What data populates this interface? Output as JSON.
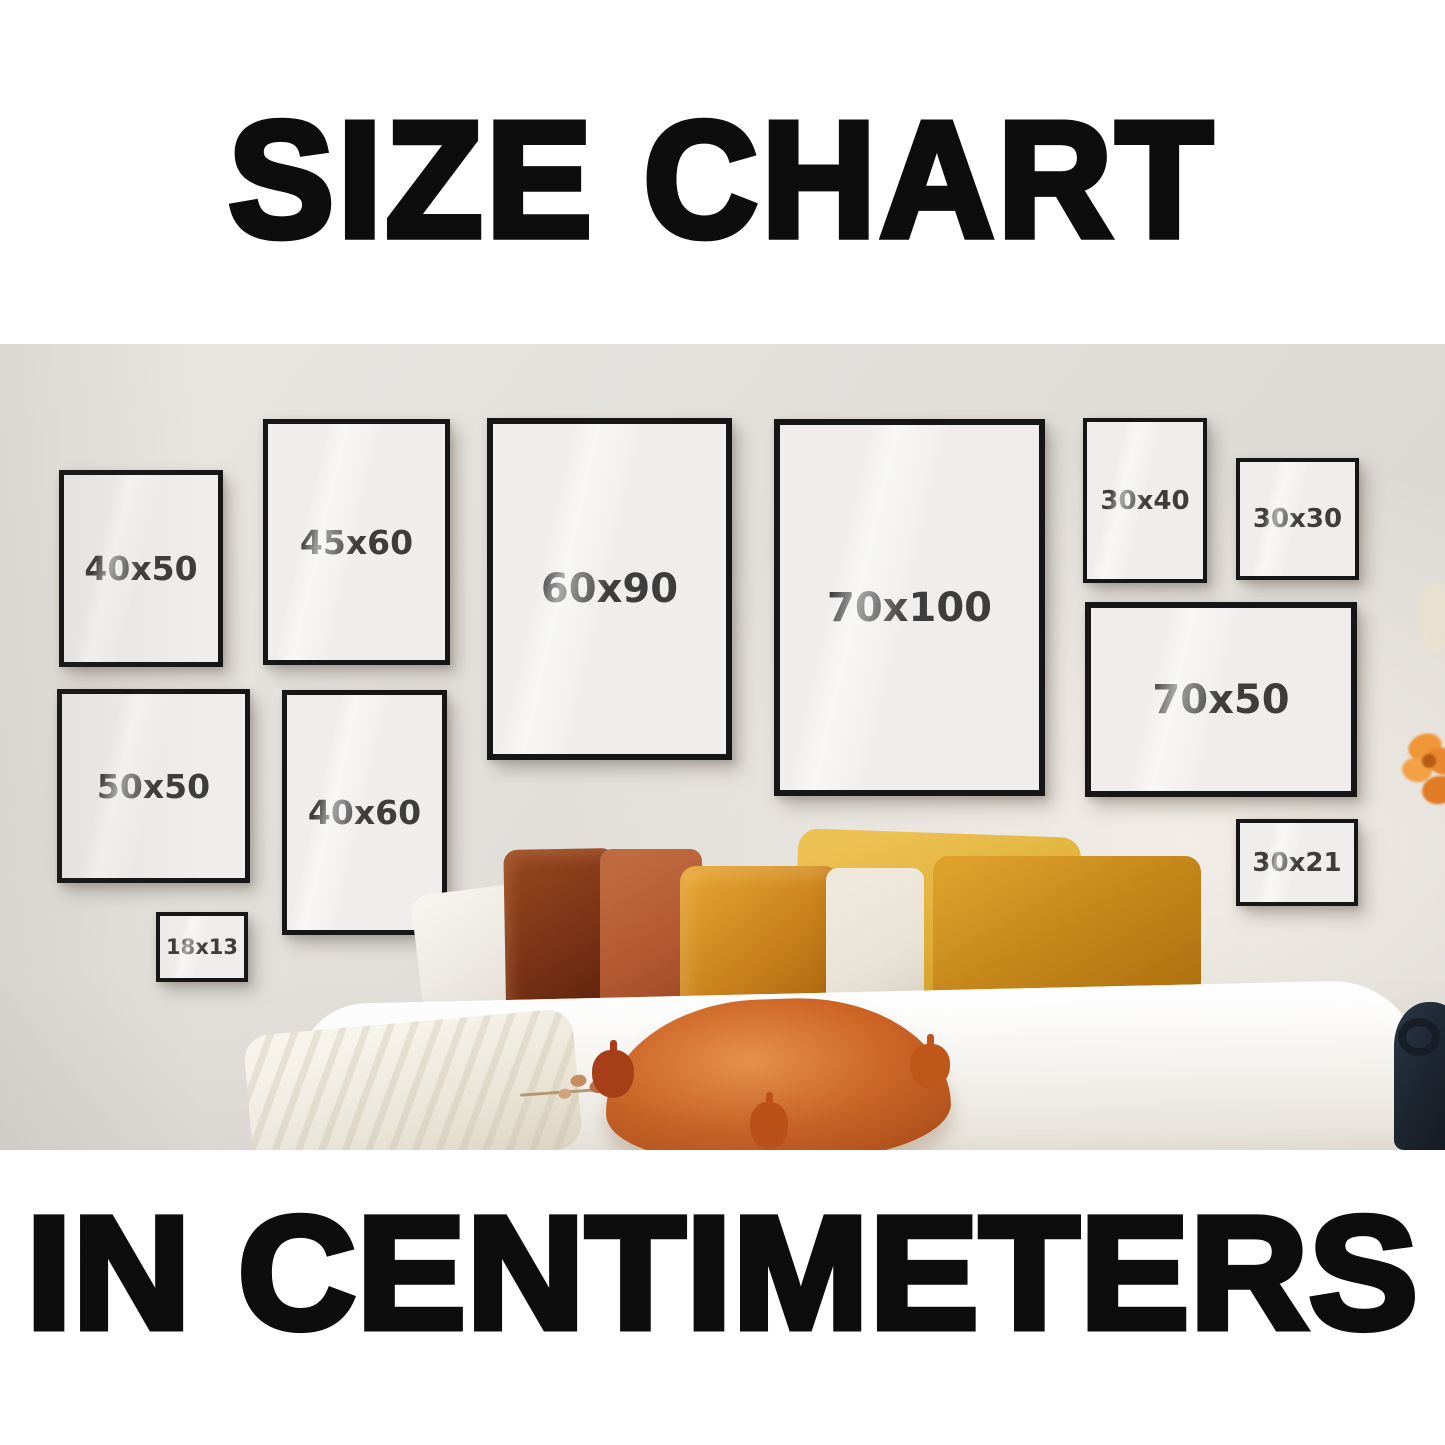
{
  "header": {
    "title": "SIZE CHART"
  },
  "footer": {
    "text": "IN CENTIMETERS"
  },
  "frames": [
    {
      "label": "40x50",
      "width_cm": 40,
      "height_cm": 50
    },
    {
      "label": "45x60",
      "width_cm": 45,
      "height_cm": 60
    },
    {
      "label": "60x90",
      "width_cm": 60,
      "height_cm": 90
    },
    {
      "label": "70x100",
      "width_cm": 70,
      "height_cm": 100
    },
    {
      "label": "30x40",
      "width_cm": 30,
      "height_cm": 40
    },
    {
      "label": "30x30",
      "width_cm": 30,
      "height_cm": 30
    },
    {
      "label": "70x50",
      "width_cm": 70,
      "height_cm": 50
    },
    {
      "label": "50x50",
      "width_cm": 50,
      "height_cm": 50
    },
    {
      "label": "40x60",
      "width_cm": 40,
      "height_cm": 60
    },
    {
      "label": "18x13",
      "width_cm": 18,
      "height_cm": 13
    },
    {
      "label": "30x21",
      "width_cm": 30,
      "height_cm": 21
    }
  ],
  "colors": {
    "frame_border": "#161616",
    "frame_fill": "#efeeec",
    "label_text": "#3d3d3d",
    "title_text": "#0d0d0d",
    "wall": "#e2dfdb",
    "background": "#ffffff",
    "pillow_rust": "#7e3517",
    "pillow_terracotta": "#b45a33",
    "pillow_amber": "#c87f1c",
    "pillow_gold": "#ddab33",
    "pillow_cream": "#e9e3d6",
    "pillow_orange": "#cf6526",
    "bedding_white": "#f8f6f2"
  }
}
